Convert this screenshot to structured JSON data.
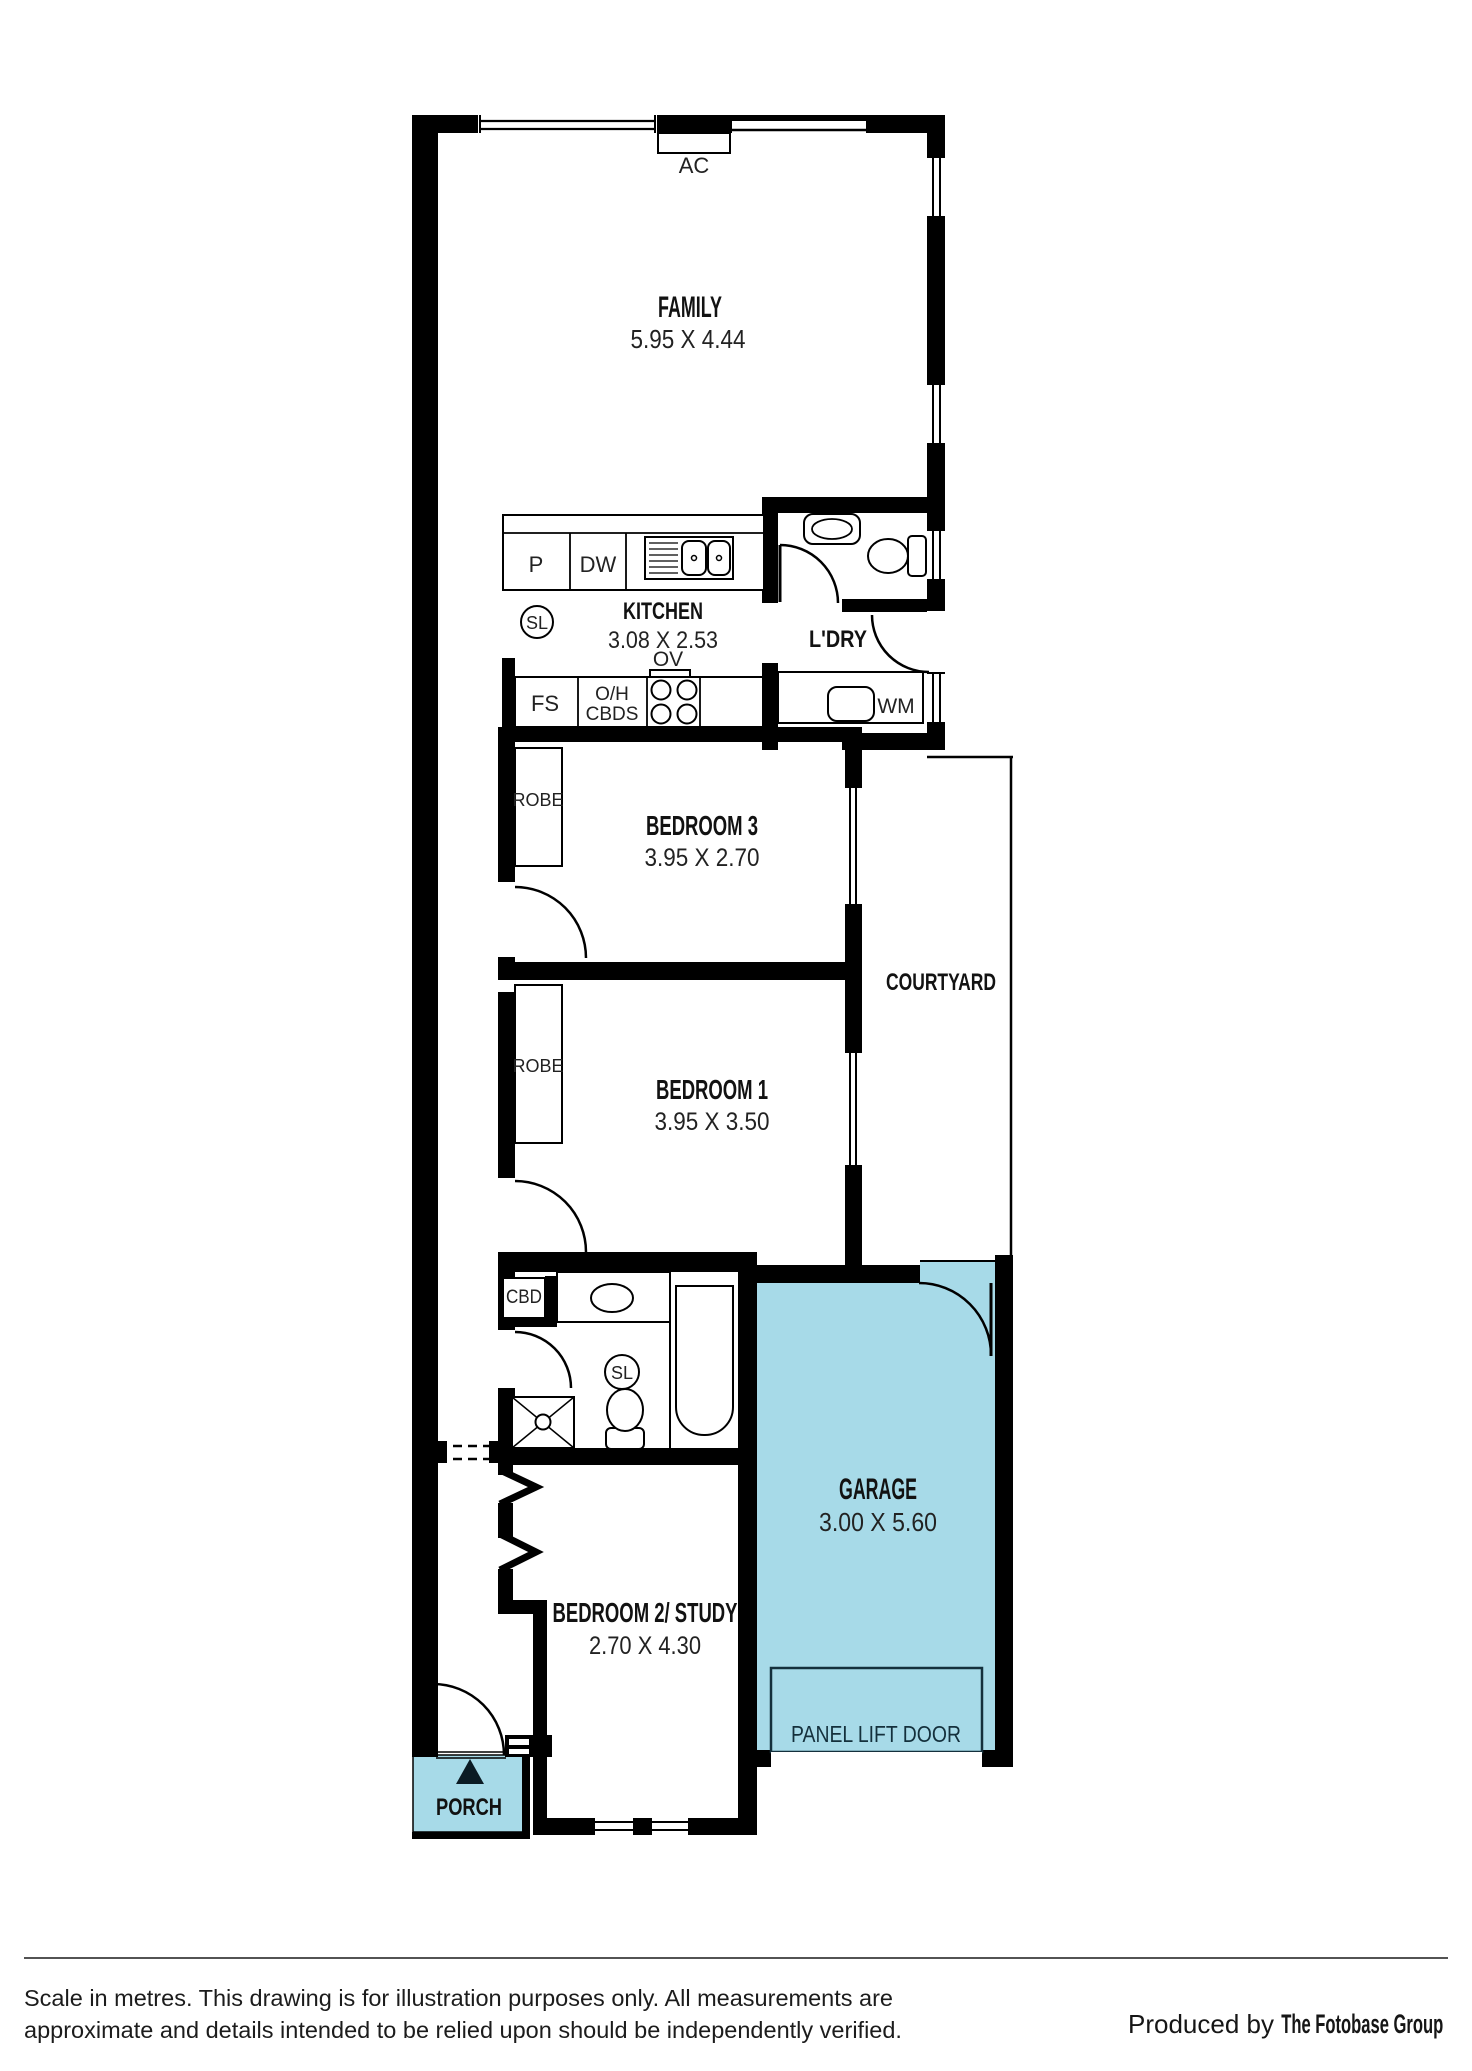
{
  "plan": {
    "rooms": {
      "family": {
        "name": "FAMILY",
        "dims": "5.95 X 4.44"
      },
      "kitchen": {
        "name": "KITCHEN",
        "dims": "3.08 X 2.53"
      },
      "laundry": {
        "name": "L'DRY"
      },
      "bedroom3": {
        "name": "BEDROOM 3",
        "dims": "3.95 X 2.70"
      },
      "courtyard": {
        "name": "COURTYARD"
      },
      "bedroom1": {
        "name": "BEDROOM 1",
        "dims": "3.95 X 3.50"
      },
      "garage": {
        "name": "GARAGE",
        "dims": "3.00 X 5.60"
      },
      "bedroom2": {
        "name": "BEDROOM 2/ STUDY",
        "dims": "2.70 X 4.30"
      },
      "porch": {
        "name": "PORCH"
      }
    },
    "fixtures": {
      "ac": "AC",
      "pantry": "P",
      "dishwasher": "DW",
      "skylight": "SL",
      "oven": "OV",
      "fridge_space": "FS",
      "overhead_line1": "O/H",
      "overhead_line2": "CBDS",
      "washing_machine": "WM",
      "robe": "ROBE",
      "cupboard": "CBD",
      "panel_lift_door": "PANEL LIFT DOOR"
    },
    "colors": {
      "wall": "#000000",
      "highlight_fill": "#a7dae8",
      "ink": "#161616",
      "blue_ink": "#14303c"
    }
  },
  "footer": {
    "disclaimer_line1": "Scale in metres. This drawing is for illustration purposes only. All measurements are",
    "disclaimer_line2": "approximate and details intended to be relied upon should be independently verified.",
    "credit_prefix": "Produced by ",
    "credit_name": "The Fotobase Group"
  }
}
